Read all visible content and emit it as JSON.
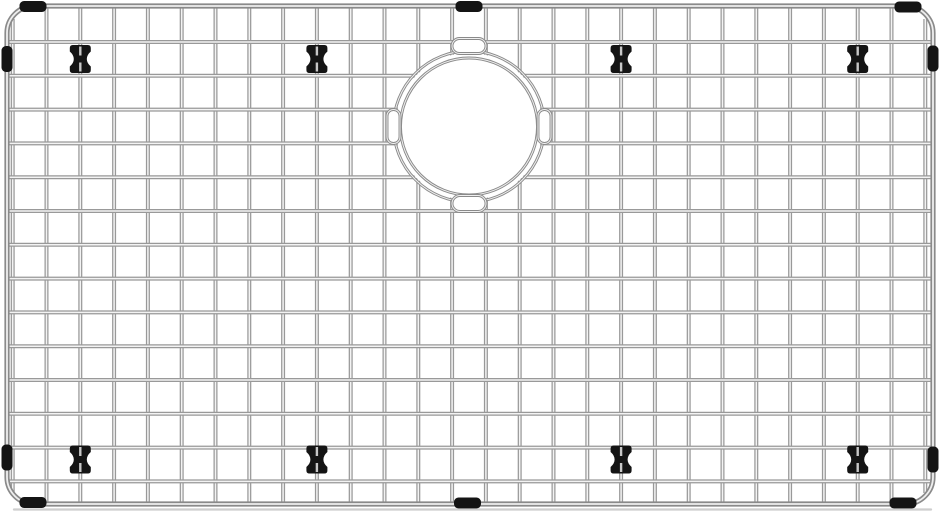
{
  "image": {
    "description": "Stainless steel kitchen sink bottom grid with wire lattice, circular drain opening, black rubber edge bumpers and feet",
    "background_color": "#ffffff",
    "canvas": {
      "width": 940,
      "height": 511
    }
  },
  "colors": {
    "wire_edge": "#999999",
    "wire_highlight": "#f3f3f3",
    "frame_edge": "#8a8a8a",
    "frame_highlight": "#efefef",
    "ring_edge": "#8a8a8a",
    "ring_highlight": "#f0f0f0",
    "rubber_black": "#141414",
    "wire_slit": "#c7c7c7",
    "shadow_line": "#c6c6c6",
    "white": "#ffffff"
  },
  "frame": {
    "x": 7,
    "y": 6,
    "width": 926,
    "height": 498,
    "corner_radius": 27,
    "stroke_width": 5.2,
    "highlight_width": 1.8
  },
  "grid": {
    "vertical_wires": {
      "count": 28,
      "start": 12.7,
      "spacing": 33.8,
      "from": 6,
      "to": 504,
      "corner_trim_from": 19,
      "corner_trim_to": 493
    },
    "horizontal_wires": {
      "count": 14,
      "start": 42,
      "spacing": 33.8,
      "from": 9,
      "to": 931
    },
    "wire_width": 4.0,
    "highlight_width": 1.5
  },
  "drain_opening": {
    "cx": 469,
    "cy": 126.5,
    "outer_radius": 75.5,
    "inner_radius": 68.5,
    "white_radius": 73.5,
    "ring_width": 2.9,
    "ring_highlight_width": 1.0,
    "loops": [
      {
        "side": "top",
        "x": 452,
        "y": 38.5,
        "width": 34,
        "height": 15,
        "rx": 7.5
      },
      {
        "side": "bottom",
        "x": 452,
        "y": 195.5,
        "width": 34,
        "height": 16,
        "rx": 8
      },
      {
        "side": "left",
        "x": 387,
        "y": 109.5,
        "width": 13,
        "height": 34,
        "rx": 6.5
      },
      {
        "side": "right",
        "x": 538,
        "y": 109.5,
        "width": 13,
        "height": 34,
        "rx": 6.5
      }
    ]
  },
  "feet": {
    "count": 8,
    "width": 21,
    "height": 28,
    "waist": 6.5,
    "positions": [
      {
        "x": 80.3,
        "y": 59
      },
      {
        "x": 316.9,
        "y": 59
      },
      {
        "x": 621.1,
        "y": 59
      },
      {
        "x": 857.7,
        "y": 59
      },
      {
        "x": 80.3,
        "y": 459.5
      },
      {
        "x": 316.9,
        "y": 459.5
      },
      {
        "x": 621.1,
        "y": 459.5
      },
      {
        "x": 857.7,
        "y": 459.5
      }
    ]
  },
  "edge_bumpers": {
    "count": 10,
    "horizontal_size": {
      "width": 27,
      "height": 11
    },
    "vertical_size": {
      "width": 11,
      "height": 26
    },
    "items": [
      {
        "edge": "top",
        "cx": 33,
        "cy": 6.5
      },
      {
        "edge": "top",
        "cx": 469,
        "cy": 6.5
      },
      {
        "edge": "top",
        "cx": 908,
        "cy": 7
      },
      {
        "edge": "bottom",
        "cx": 33,
        "cy": 502.5
      },
      {
        "edge": "bottom",
        "cx": 467.5,
        "cy": 503
      },
      {
        "edge": "bottom",
        "cx": 903,
        "cy": 503
      },
      {
        "edge": "left",
        "cx": 7,
        "cy": 59
      },
      {
        "edge": "left",
        "cx": 7,
        "cy": 457.5
      },
      {
        "edge": "right",
        "cx": 933,
        "cy": 58.5
      },
      {
        "edge": "right",
        "cx": 933,
        "cy": 459.5
      }
    ]
  },
  "shadow": {
    "x1": 14,
    "x2": 931,
    "y": 509.5,
    "width": 2.3
  }
}
